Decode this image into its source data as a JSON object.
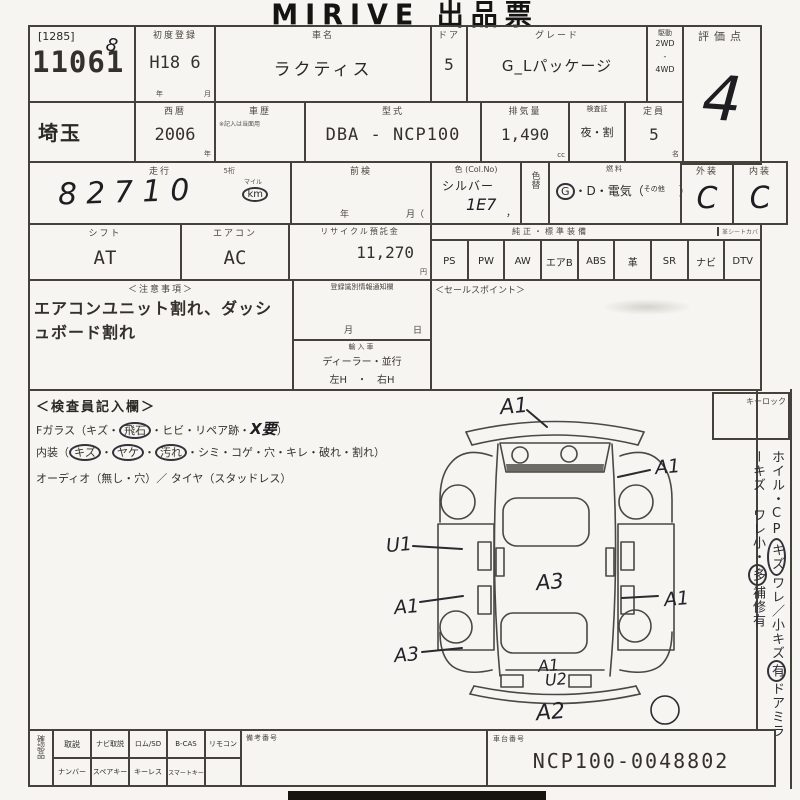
{
  "title": "MIRIVE 出品票",
  "lot": {
    "bracket": "[1285]",
    "number": "11061",
    "hand_mark": "8"
  },
  "row1": {
    "first_reg": {
      "label": "初度登録",
      "value": "H18 6",
      "year": "年",
      "month": "月"
    },
    "car_name": {
      "label": "車名",
      "value": "ラクティス"
    },
    "doors": {
      "label": "ドア",
      "value": "5"
    },
    "grade": {
      "label": "グレード",
      "value": "G_Lパッケージ"
    },
    "drive": {
      "label": "駆動",
      "opt1": "2WD",
      "sep": "-",
      "opt2": "4WD"
    },
    "score": {
      "label": "評価点",
      "value": "4"
    }
  },
  "row2": {
    "prefecture": "埼玉",
    "year": {
      "label": "西暦",
      "value": "2006",
      "unit": "年"
    },
    "history": {
      "label": "車歴",
      "note": "※記入は当面用"
    },
    "model_code": {
      "label": "型式",
      "value": "DBA - NCP100"
    },
    "displacement": {
      "label": "排気量",
      "value": "1,490",
      "unit": "cc"
    },
    "inspection": {
      "label": "検査証",
      "value": "夜・割"
    },
    "capacity": {
      "label": "定員",
      "value": "5",
      "unit": "名"
    }
  },
  "row3": {
    "mileage": {
      "label": "走行",
      "sub": "5桁",
      "value": "82710",
      "unit_top": "マイル",
      "unit": "km"
    },
    "prev_inspection": {
      "label": "前検",
      "year": "年",
      "month": "月（"
    },
    "color": {
      "label": "色 (Col.No)",
      "value": "シルバー",
      "code": "1E7",
      "comma": "，"
    },
    "color_change": "色替",
    "fuel": {
      "label": "燃料",
      "g": "G",
      "mid": "・D・電気（",
      "other": "その他",
      "close": "）"
    },
    "exterior": {
      "label": "外装",
      "value": "C"
    },
    "interior": {
      "label": "内装",
      "value": "C"
    }
  },
  "row4": {
    "shift": {
      "label": "シフト",
      "value": "AT"
    },
    "aircon": {
      "label": "エアコン",
      "value": "AC"
    },
    "recycle": {
      "label": "リサイクル預託金",
      "value": "11,270",
      "unit": "円"
    },
    "equipment": {
      "label": "純正・標準装備",
      "note": "革シートカバ",
      "items": [
        "PS",
        "PW",
        "AW",
        "エアB",
        "ABS",
        "革",
        "SR",
        "ナビ",
        "DTV"
      ]
    }
  },
  "notes": {
    "label": "＜注意事項＞",
    "text": "エアコンユニット割れ、ダッシュボード割れ"
  },
  "registration": {
    "label": "登録識別情報通知欄",
    "month": "月",
    "day": "日"
  },
  "import": {
    "label": "輸入車",
    "line1": "ディーラー・並行",
    "line2": "左H　・　右H"
  },
  "sales_point": {
    "label": "＜セールスポイント＞"
  },
  "inspector": {
    "label": "＜検査員記入欄＞",
    "line1_head": "Fガラス（キズ・",
    "line1_circled": "飛石",
    "line1_mid": "・ヒビ・リペア跡・",
    "line1_hand": "X要",
    "line1_close": "）",
    "line2_head": "内装（",
    "line2_c1": "キズ",
    "line2_c2": "ヤケ",
    "line2_c3": "汚れ",
    "dot": "・",
    "line2_rest": "シミ・コゲ・穴・キレ・破れ・割れ）",
    "line3": "オーディオ（無し・穴）／ タイヤ（スタッドレス）"
  },
  "keylock_label": "キーロック",
  "side_note": {
    "p1": "ホイル・CP",
    "c1": "キズ",
    "p2": "ワレ／小キズ",
    "c2": "有",
    "p3": "ドアミラーキズ ワレ",
    "p4": "小・",
    "c3": "多",
    "p5": "補修有"
  },
  "diagram": {
    "codes": [
      "A1",
      "A1",
      "U1",
      "A3",
      "A1",
      "A1",
      "A3",
      "A1",
      "U2",
      "A2"
    ]
  },
  "confirm": {
    "label": "確認品",
    "row1": [
      "取説",
      "ナビ取説",
      "ロム/SD",
      "B-CAS",
      "リモコン"
    ],
    "row2": [
      "ナンバー",
      "スペアキー",
      "キーレス",
      "スマートキー"
    ],
    "remarks_label": "備考番号"
  },
  "chassis": {
    "label": "車台番号",
    "value": "NCP100-0048802"
  }
}
